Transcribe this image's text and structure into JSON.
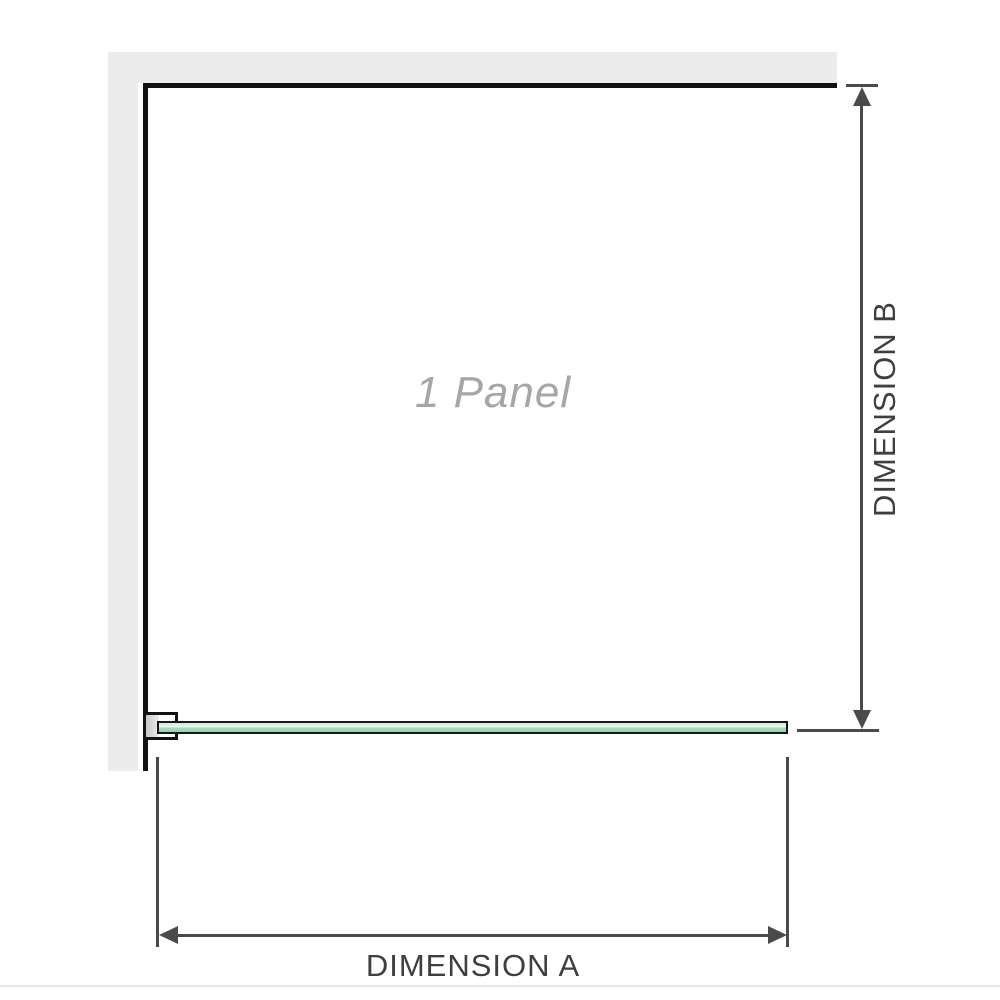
{
  "diagram": {
    "panel_label": "1 Panel",
    "dimensions": {
      "horizontal": {
        "label": "DIMENSION A"
      },
      "vertical": {
        "label": "DIMENSION B"
      }
    },
    "colors": {
      "wall_fill": "#ececec",
      "panel_outline": "#121212",
      "glass_outline": "#161616",
      "glass_fill_light": "#dff1e7",
      "glass_fill_dark": "#9bd1b2",
      "bracket_pad": "#c6c6c6",
      "dimension_line": "#4a4a4a",
      "dimension_text": "#3f3f3f",
      "panel_label_text": "#a6a6a6",
      "footer_divider": "#e9e6e1"
    }
  }
}
